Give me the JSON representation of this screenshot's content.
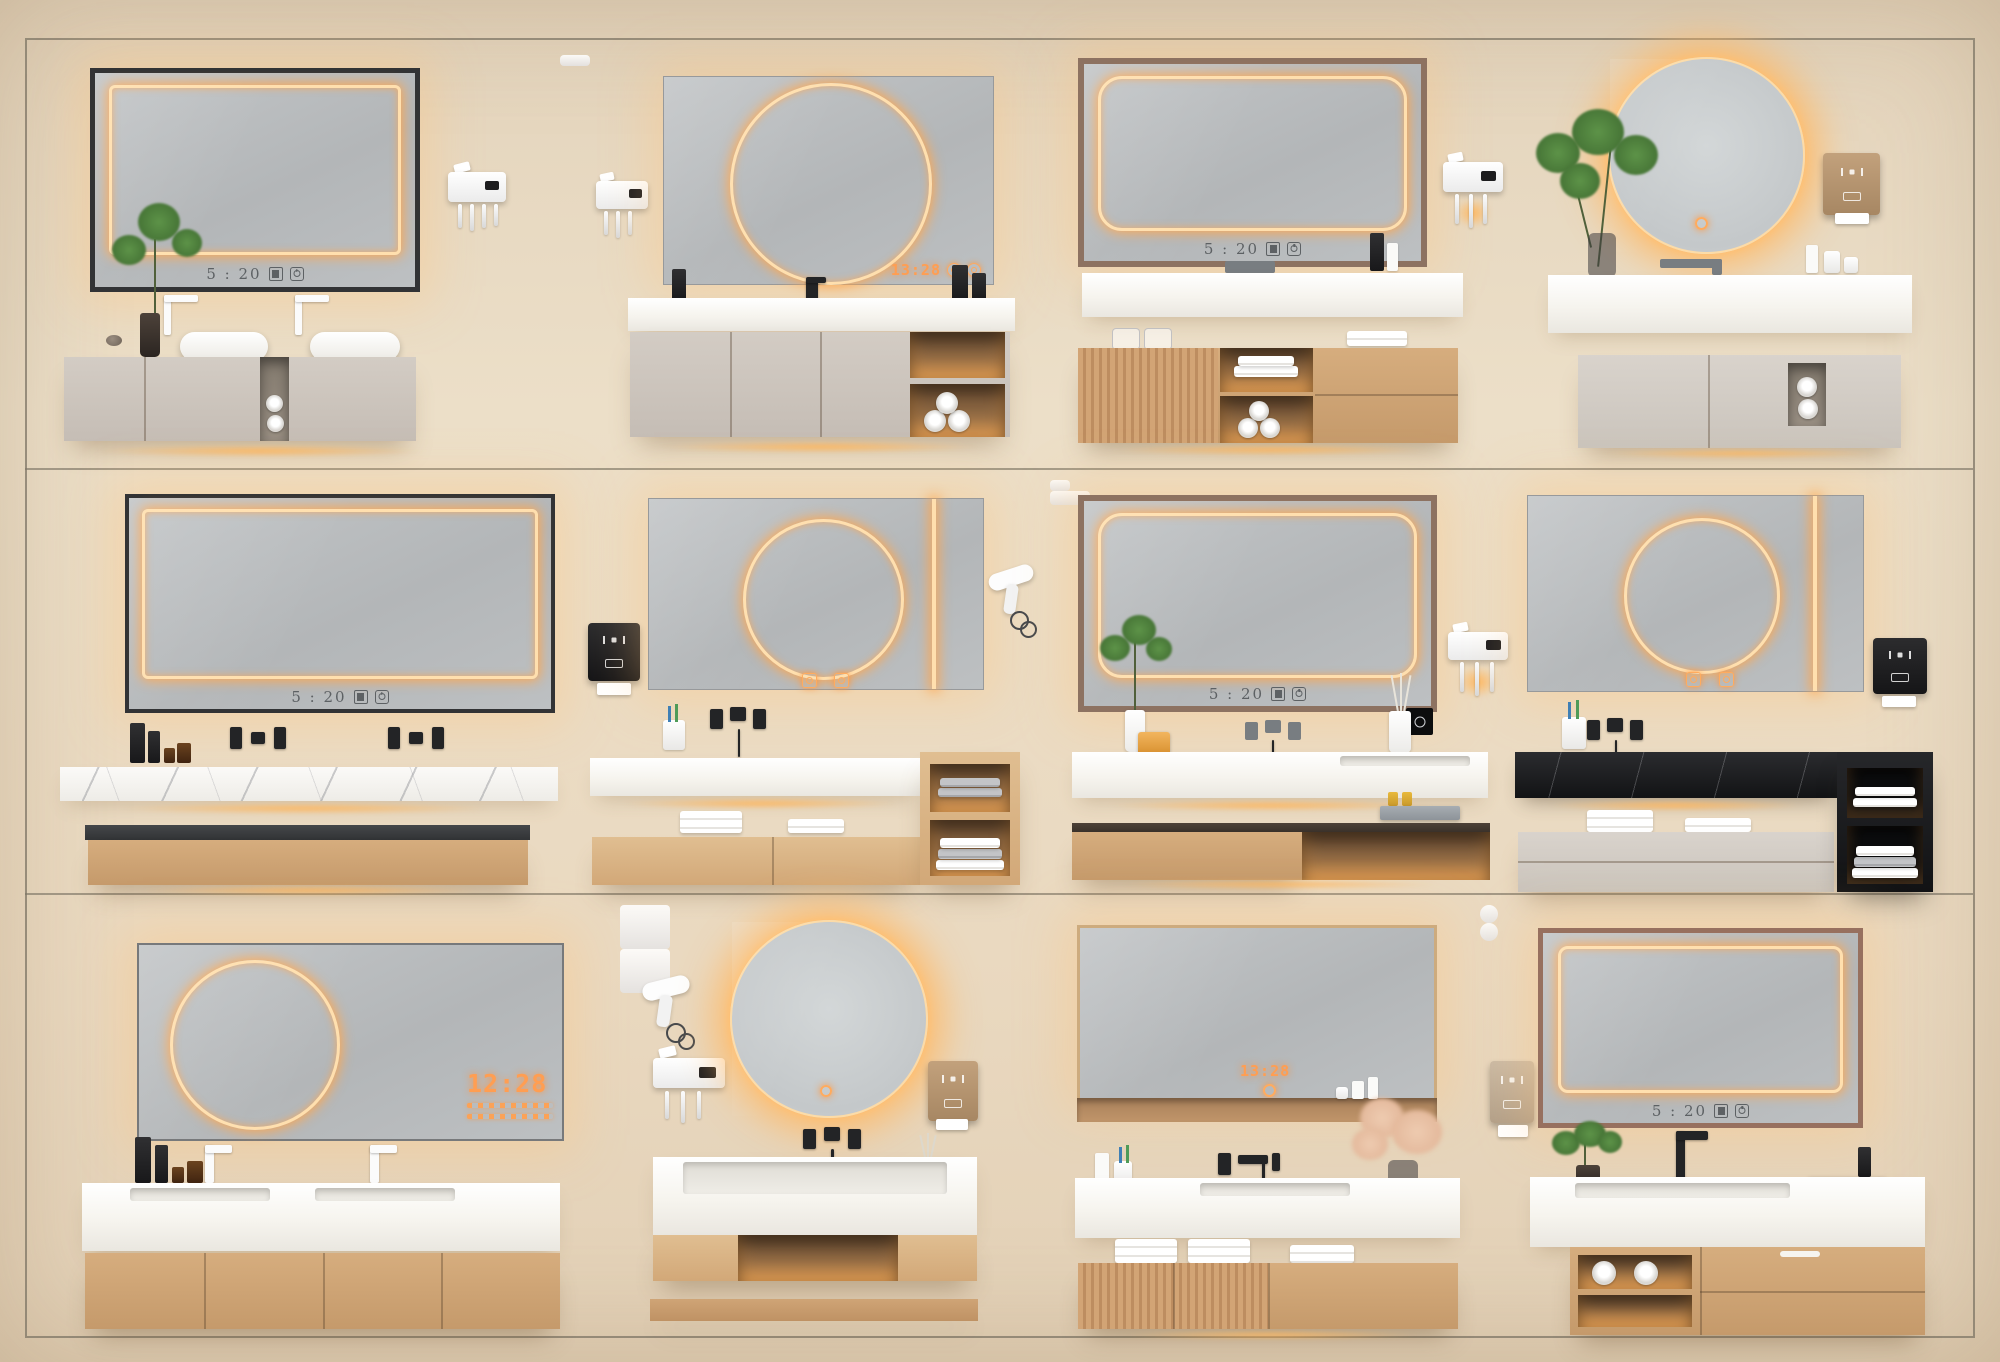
{
  "meta": {
    "type": "3d-render-showcase",
    "subject": "LED-mirror bathroom vanity collection",
    "grid": "3 rows x 4 columns"
  },
  "palette": {
    "wall": "#e8dac2",
    "frame_line": "#7d7566",
    "mirror_glass": "#b8bbbd",
    "led_line": "#ffdfae",
    "led_glow": "#ffa64d",
    "counter_white": "#f7f5f0",
    "marble_white": "#f3f2ee",
    "marble_black": "#1c1d20",
    "cabinet_beige": "#cdc5bc",
    "cabinet_oak": "#cfa678",
    "clock_dark": "#5d6164",
    "clock_led": "#ff9e52",
    "towel_white": "#f2f1ed",
    "accent_black": "#232426"
  },
  "scenes": [
    {
      "id": "r1c1",
      "mirror": {
        "shape": "rectangular",
        "frame": "black",
        "led": "inner-rectangle",
        "clock": "5 : 20",
        "clock_style": "dark",
        "icons": [
          "display-icon",
          "power-icon"
        ]
      },
      "wall_items": [
        "toothbrush-holder"
      ],
      "decor": [
        "green-plant",
        "pebble"
      ],
      "vanity": {
        "basins": 2,
        "faucets": "white-deck",
        "cabinet": "beige-floating",
        "niche": "center-towel-rolls",
        "underglow": true
      }
    },
    {
      "id": "r1c2",
      "mirror": {
        "shape": "rectangular-frameless",
        "led": "circle",
        "clock": "13:28",
        "clock_style": "led",
        "icons": [
          "ring-icon",
          "ring-icon"
        ]
      },
      "wall_items": [
        "toothbrush-holder"
      ],
      "decor": [
        "black-soap-bottles",
        "towel-roll"
      ],
      "vanity": {
        "counter": "white",
        "faucets": "black-deck",
        "cabinet": "beige-floating",
        "niche": "right-open-shelf-rolls",
        "underglow": true
      }
    },
    {
      "id": "r1c3",
      "mirror": {
        "shape": "rectangular",
        "frame": "walnut",
        "led": "rounded-rectangle",
        "clock": "5 : 20",
        "clock_style": "dark",
        "icons": [
          "display-icon",
          "power-icon"
        ]
      },
      "wall_items": [
        "toothbrush-holder"
      ],
      "decor": [
        "black-bottle",
        "white-pump",
        "glass-jars",
        "towel-stack"
      ],
      "vanity": {
        "counter": "white-shelf",
        "faucets": "grey-deck",
        "cabinet": "oak-fluted-left",
        "niche": "center-shelves-towels",
        "underglow": true
      }
    },
    {
      "id": "r1c4",
      "mirror": {
        "shape": "round",
        "led": "halo",
        "clock": null,
        "touch_button": true
      },
      "wall_items": [
        "paper-dispenser-tan"
      ],
      "decor": [
        "tall-plant",
        "toiletries",
        "toothbrush-cup"
      ],
      "vanity": {
        "counter": "white-thick",
        "faucets": "grey-deck",
        "cabinet": "beige-floating",
        "niche": "towel-nook",
        "underglow": true
      }
    },
    {
      "id": "r2c1",
      "mirror": {
        "shape": "rectangular",
        "frame": "black",
        "led": "inner-rectangle",
        "clock": "5 : 20",
        "clock_style": "dark",
        "icons": [
          "display-icon",
          "power-icon"
        ]
      },
      "wall_items": [],
      "decor": [
        "black-pump-bottles",
        "amber-jars"
      ],
      "vanity": {
        "counter": "white-marble",
        "faucets": "black-wall-x2",
        "cabinet": "oak-with-dark-top",
        "underglow": true
      }
    },
    {
      "id": "r2c2",
      "mirror": {
        "shape": "rectangular-frameless",
        "led": "circle-plus-vertical-bar",
        "clock": null,
        "touch_icons": 2
      },
      "wall_items": [
        "soap-dispenser-black",
        "hair-dryer"
      ],
      "decor": [
        "toothbrush-cup"
      ],
      "vanity": {
        "counter": "white",
        "faucets": "black-wall",
        "cabinet": "oak-low",
        "niche": "right-tower-towels",
        "underglow": true
      }
    },
    {
      "id": "r2c3",
      "mirror": {
        "shape": "rectangular",
        "frame": "walnut",
        "led": "rounded-rectangle",
        "clock": "5 : 20",
        "clock_style": "dark",
        "icons": [
          "display-icon",
          "power-icon"
        ]
      },
      "wall_items": [
        "toothbrush-holder"
      ],
      "decor": [
        "green-plant",
        "soap-bar",
        "diffuser-sticks",
        "amenity-tray",
        "towel-roll",
        "black-logo-card"
      ],
      "vanity": {
        "counter": "white",
        "faucets": "wall-mounted",
        "cabinet": "oak-dark-top",
        "niche": "right-lighted-shelf",
        "underglow": true
      }
    },
    {
      "id": "r2c4",
      "mirror": {
        "shape": "rectangular-frameless",
        "led": "circle-plus-vertical-bar",
        "clock": null,
        "touch_icons": 2
      },
      "wall_items": [
        "soap-dispenser-black"
      ],
      "decor": [
        "toothbrush-cup",
        "beige-towels"
      ],
      "vanity": {
        "counter": "black-marble",
        "faucets": "black-wall",
        "cabinet": "grey-drawers",
        "niche": "black-tower-towels",
        "underglow": true
      }
    },
    {
      "id": "r3c1",
      "mirror": {
        "shape": "rectangular-frameless",
        "led": "circle",
        "clock": "12:28",
        "clock_style": "led-large",
        "icons": [
          "menu-rows"
        ]
      },
      "wall_items": [],
      "decor": [
        "black-pump-bottles",
        "amber-jars"
      ],
      "vanity": {
        "counter": "white-double-sink",
        "faucets": "white-deck-x2",
        "cabinet": "oak-four-door",
        "underglow": false
      }
    },
    {
      "id": "r3c2",
      "mirror": {
        "shape": "round",
        "led": "halo",
        "clock": null,
        "touch_button": true
      },
      "wall_items": [
        "hair-dryer",
        "toothbrush-holder",
        "soap-dispenser-tan"
      ],
      "decor": [
        "reed-diffuser"
      ],
      "vanity": {
        "counter": "white-wide-sink",
        "faucets": "black-wall",
        "cabinet": "oak-open-center",
        "base": "oak-plinth",
        "underglow": true
      }
    },
    {
      "id": "r3c3",
      "mirror": {
        "shape": "rectangular",
        "frame": "oak-with-shelf",
        "led": "none",
        "clock": "13:28",
        "clock_style": "led",
        "icons": [
          "power-icon"
        ]
      },
      "wall_items": [],
      "decor": [
        "white-bottles",
        "toothbrush-cup",
        "pampas-grass",
        "towel-stacks"
      ],
      "vanity": {
        "counter": "white",
        "faucets": "black-wall",
        "cabinet": "oak-fluted-left",
        "underglow": true
      }
    },
    {
      "id": "r3c4",
      "mirror": {
        "shape": "rectangular",
        "frame": "walnut",
        "led": "inner-rectangle",
        "clock": "5 : 20",
        "clock_style": "dark",
        "icons": [
          "display-icon",
          "power-icon"
        ]
      },
      "wall_items": [
        "paper-dispenser-grey"
      ],
      "decor": [
        "green-plant",
        "black-tray-rolls"
      ],
      "vanity": {
        "counter": "white-sink",
        "faucets": "black-deck-tall",
        "cabinet": "oak-drawers",
        "niche": "left-lighted-shelves-rolls",
        "underglow": true
      }
    }
  ]
}
